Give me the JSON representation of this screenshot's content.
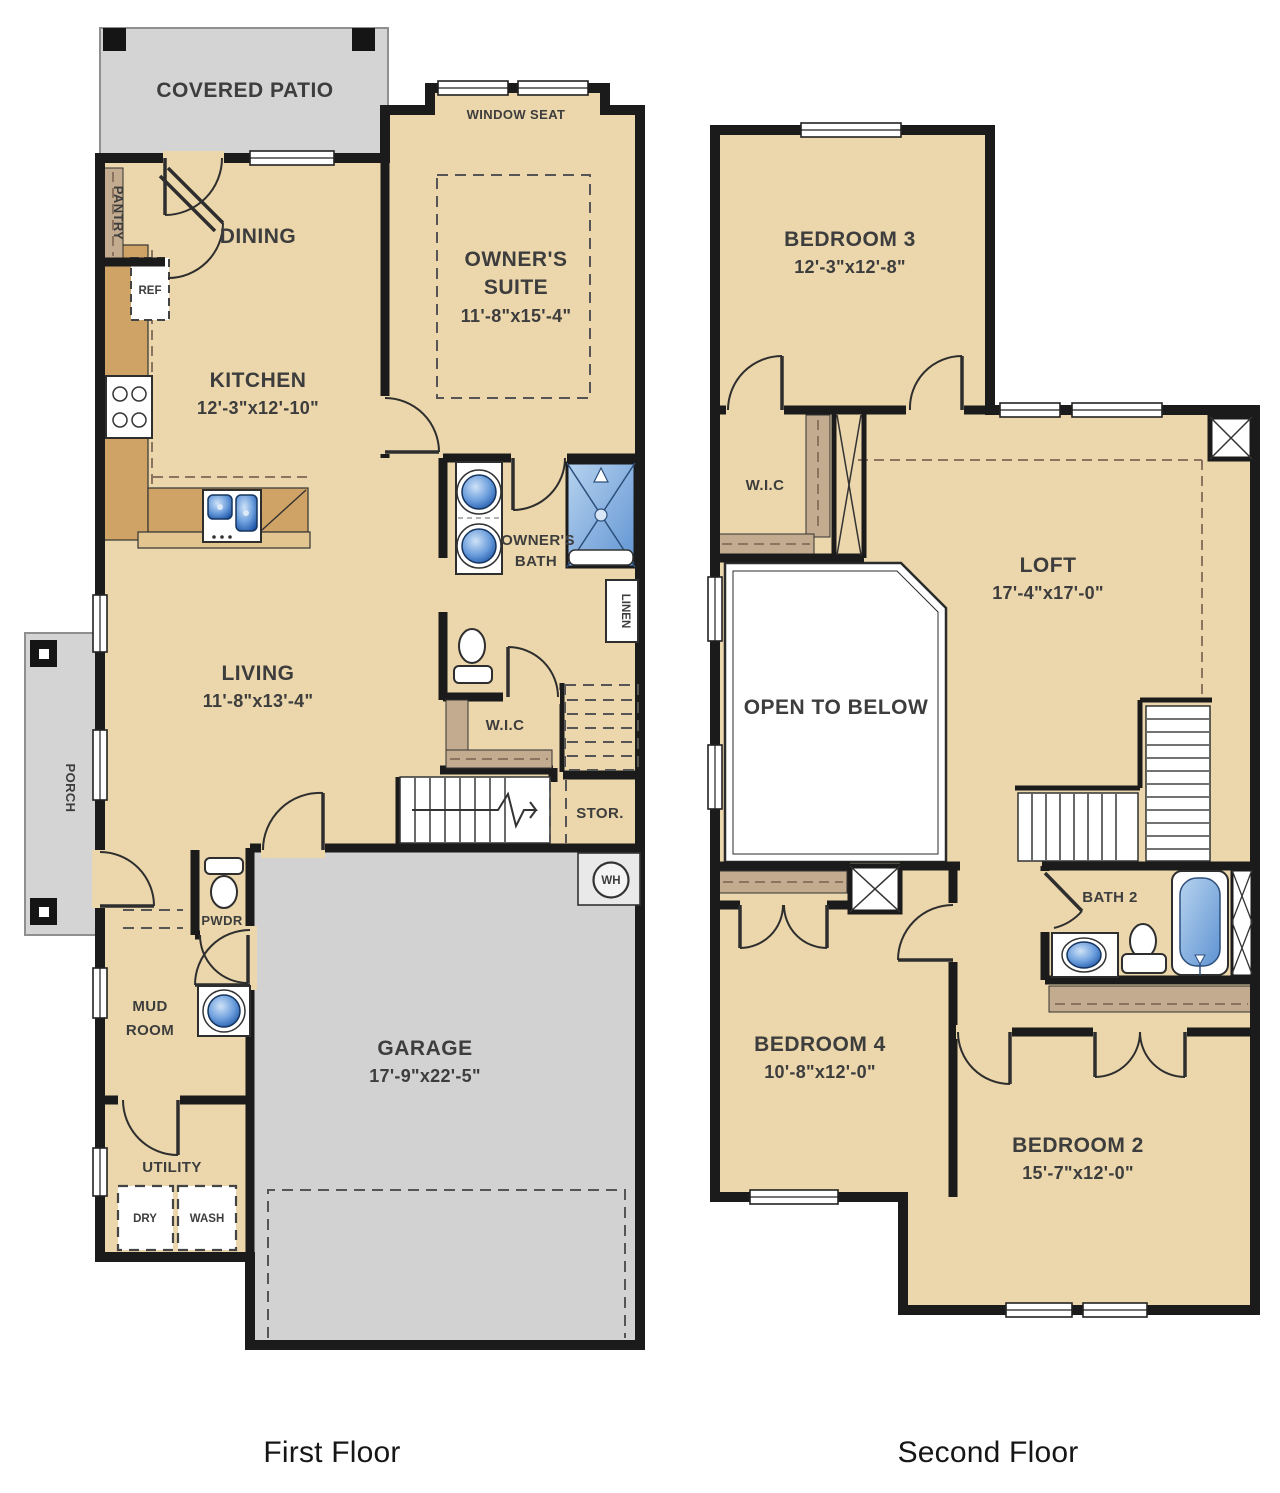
{
  "colors": {
    "floor_tan": "#ebd7ab",
    "outdoor_gray": "#d4d4d4",
    "wall_black": "#1b1b1b",
    "cabinet_brown": "#cfa265",
    "island_tan": "#e2c58f",
    "closet_shelf_brown": "#c2ab8e",
    "fixture_blue": "#4f87d4",
    "fixture_blue_light": "#b9d4f0",
    "label_gray": "#3d3d3d"
  },
  "floors": {
    "first": {
      "label": "First Floor",
      "rooms": {
        "covered_patio": {
          "name": "COVERED PATIO"
        },
        "window_seat": {
          "name": "WINDOW SEAT"
        },
        "pantry": {
          "name": "PANTRY"
        },
        "dining": {
          "name": "DINING"
        },
        "ref": {
          "name": "REF"
        },
        "kitchen": {
          "name": "KITCHEN",
          "dims": "12'-3\"x12'-10\""
        },
        "owners_suite": {
          "line1": "OWNER'S",
          "line2": "SUITE",
          "dims": "11'-8\"x15'-4\""
        },
        "owners_bath": {
          "line1": "OWNER'S",
          "line2": "BATH"
        },
        "linen": {
          "name": "LINEN"
        },
        "living": {
          "name": "LIVING",
          "dims": "11'-8\"x13'-4\""
        },
        "wic": {
          "name": "W.I.C"
        },
        "stor": {
          "name": "STOR."
        },
        "water_heater": {
          "name": "WH"
        },
        "pwdr": {
          "name": "PWDR"
        },
        "mud_room": {
          "line1": "MUD",
          "line2": "ROOM"
        },
        "utility": {
          "name": "UTILITY"
        },
        "dry": {
          "name": "DRY"
        },
        "wash": {
          "name": "WASH"
        },
        "garage": {
          "name": "GARAGE",
          "dims": "17'-9\"x22'-5\""
        },
        "porch": {
          "name": "PORCH"
        }
      }
    },
    "second": {
      "label": "Second Floor",
      "rooms": {
        "bedroom3": {
          "name": "BEDROOM 3",
          "dims": "12'-3\"x12'-8\""
        },
        "wic": {
          "name": "W.I.C"
        },
        "loft": {
          "name": "LOFT",
          "dims": "17'-4\"x17'-0\""
        },
        "open_to_below": {
          "name": "OPEN TO BELOW"
        },
        "bath2": {
          "name": "BATH 2"
        },
        "bedroom4": {
          "name": "BEDROOM 4",
          "dims": "10'-8\"x12'-0\""
        },
        "bedroom2": {
          "name": "BEDROOM 2",
          "dims": "15'-7\"x12'-0\""
        }
      }
    }
  }
}
